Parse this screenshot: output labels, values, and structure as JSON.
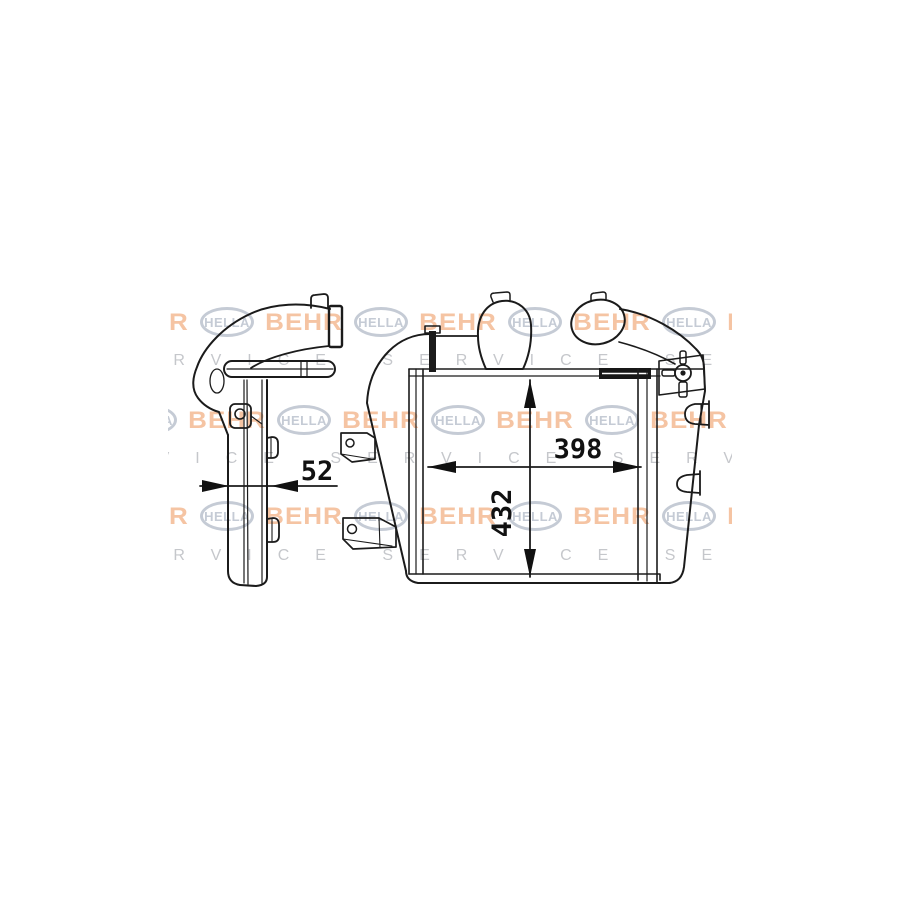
{
  "page": {
    "background": "#ffffff",
    "description": "Technical outline drawing of a BEHR HELLA SERVICE charge-air cooler (intercooler), side view and front view with dimension arrows"
  },
  "drawing": {
    "line_color": "#1b1b1b",
    "views": [
      {
        "name": "side-view",
        "description": "Left profile view with curved inlet pipe, clamp collar, mounting bracket and narrow core"
      },
      {
        "name": "front-view",
        "description": "Front view with core, left and right tanks, two round ports, wing fastener, mounting brackets and pins"
      }
    ],
    "dimensions": {
      "depth": {
        "label": "52"
      },
      "width": {
        "label": "398"
      },
      "height": {
        "label": "432"
      }
    }
  },
  "watermark": {
    "brand_primary": "BEHR",
    "brand_secondary": "HELLA",
    "service_text": "SERVICE",
    "behr_color": "#ec8a4a",
    "hella_color": "#96a2b4",
    "service_color": "#a0a3aa"
  }
}
